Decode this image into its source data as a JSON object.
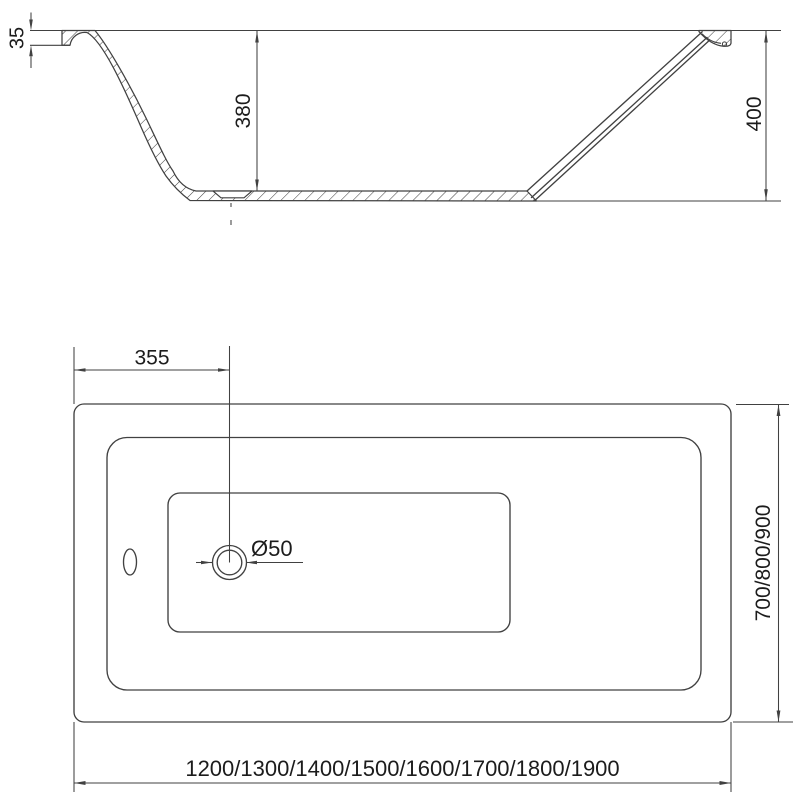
{
  "title": "Bathtub technical drawing",
  "colors": {
    "line": "#414141",
    "text": "#1c1c1c",
    "background": "#ffffff"
  },
  "section_view": {
    "rim_height_label": "35",
    "inner_depth_label": "380",
    "overall_height_label": "400"
  },
  "plan_view": {
    "drain_offset_label": "355",
    "drain_diameter_label": "Ø50",
    "width_options_label": "700/800/900",
    "length_options_label": "1200/1300/1400/1500/1600/1700/1800/1900"
  }
}
